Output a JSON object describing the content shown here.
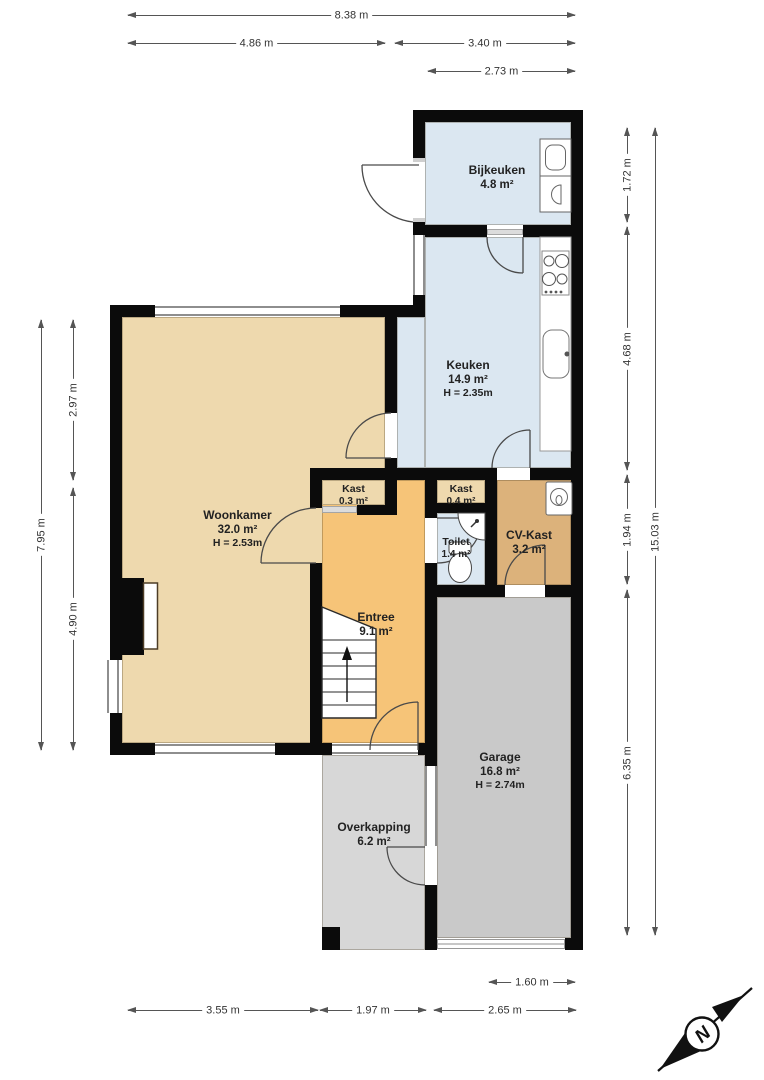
{
  "plan": {
    "rooms": [
      {
        "name": "Bijkeuken",
        "area": "4.8 m²"
      },
      {
        "name": "Keuken",
        "area": "14.9 m²",
        "height": "H = 2.35m"
      },
      {
        "name": "Woonkamer",
        "area": "32.0 m²",
        "height": "H = 2.53m"
      },
      {
        "name": "Kast",
        "area": "0.3 m²"
      },
      {
        "name": "Kast",
        "area": "0.4 m²"
      },
      {
        "name": "Toilet",
        "area": "1.4 m²"
      },
      {
        "name": "CV-Kast",
        "area": "3.2 m²"
      },
      {
        "name": "Entree",
        "area": "9.1 m²"
      },
      {
        "name": "Garage",
        "area": "16.8 m²",
        "height": "H = 2.74m"
      },
      {
        "name": "Overkapping",
        "area": "6.2 m²"
      }
    ],
    "dimensions": {
      "top": [
        "8.38 m",
        "4.86 m",
        "3.40 m",
        "2.73 m"
      ],
      "left": [
        "2.97 m",
        "4.90 m",
        "7.95 m"
      ],
      "right": [
        "1.72 m",
        "4.68 m",
        "1.94 m",
        "6.35 m",
        "15.03 m"
      ],
      "bottom": [
        "1.60 m",
        "3.55 m",
        "1.97 m",
        "2.65 m"
      ]
    },
    "compass": {
      "north_label": "N"
    },
    "palette": {
      "wet_rooms_blue": "#dbe7f1",
      "living_tan": "#eed9ae",
      "hall_orange": "#f6c478",
      "cv_caramel": "#dcb27b",
      "garage_gray": "#c9c9c9",
      "overkapping_gray": "#d7d7d7",
      "wall_black": "#0b0b0b"
    }
  }
}
